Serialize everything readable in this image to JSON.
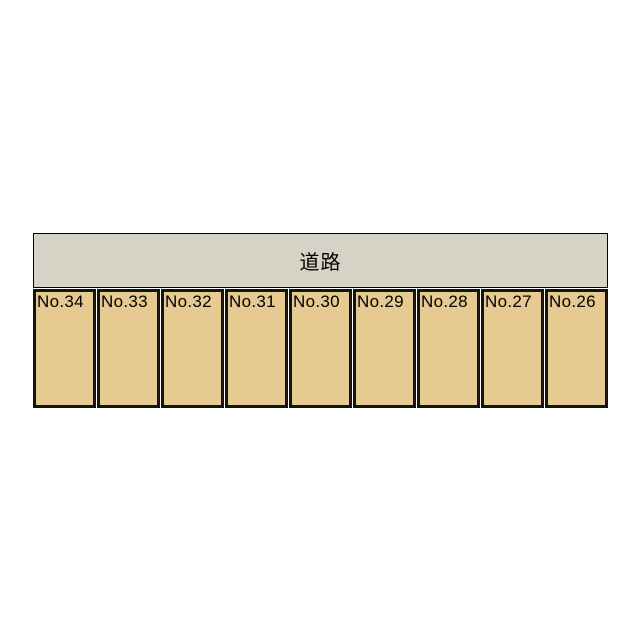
{
  "road": {
    "label": "道路",
    "fill_color": "#d5d2c6",
    "border_color": "#000000"
  },
  "parking": {
    "spaces": [
      {
        "label": "No.34"
      },
      {
        "label": "No.33"
      },
      {
        "label": "No.32"
      },
      {
        "label": "No.31"
      },
      {
        "label": "No.30"
      },
      {
        "label": "No.29"
      },
      {
        "label": "No.28"
      },
      {
        "label": "No.27"
      },
      {
        "label": "No.26"
      }
    ],
    "space_fill_color": "#e6ca92",
    "space_border_color": "#15140f",
    "label_color": "#000000"
  },
  "page": {
    "background_color": "#ffffff"
  }
}
